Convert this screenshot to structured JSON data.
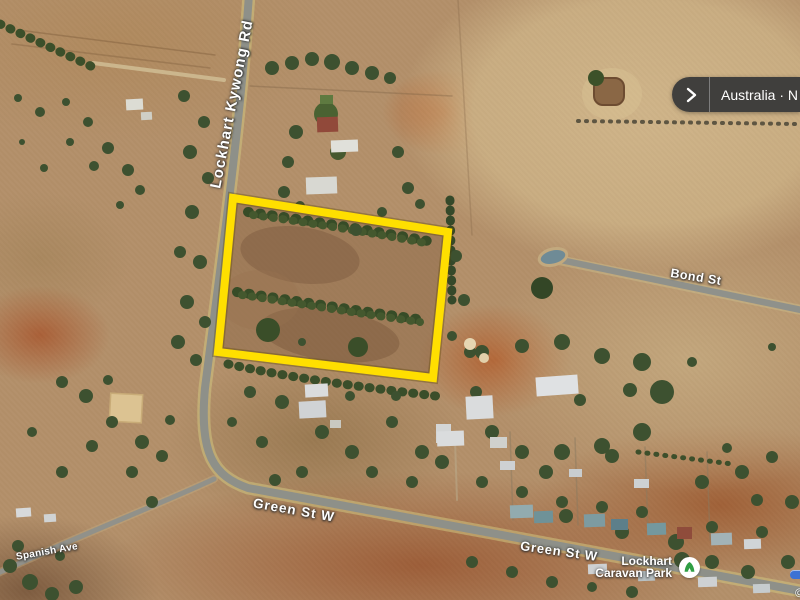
{
  "map": {
    "road_labels": [
      {
        "name": "lockhart-kywong-rd",
        "text": "Lockhart Kywong Rd"
      },
      {
        "name": "bond-st",
        "text": "Bond St"
      },
      {
        "name": "green-st-w-upper",
        "text": "Green St W"
      },
      {
        "name": "green-st-w-lower",
        "text": "Green St W"
      },
      {
        "name": "spanish-ave",
        "text": "Spanish Ave"
      }
    ],
    "poi": {
      "line1": "Lockhart",
      "line2": "Caravan Park",
      "icon": "caravan-park-icon",
      "icon_color": "#2f9e44"
    },
    "parcel": {
      "outline_color": "#ffdf00"
    },
    "attribution": "©"
  },
  "overlay": {
    "breadcrumb": {
      "chevron_icon": "chevron-right-icon",
      "location_text": "Australia · N"
    }
  }
}
